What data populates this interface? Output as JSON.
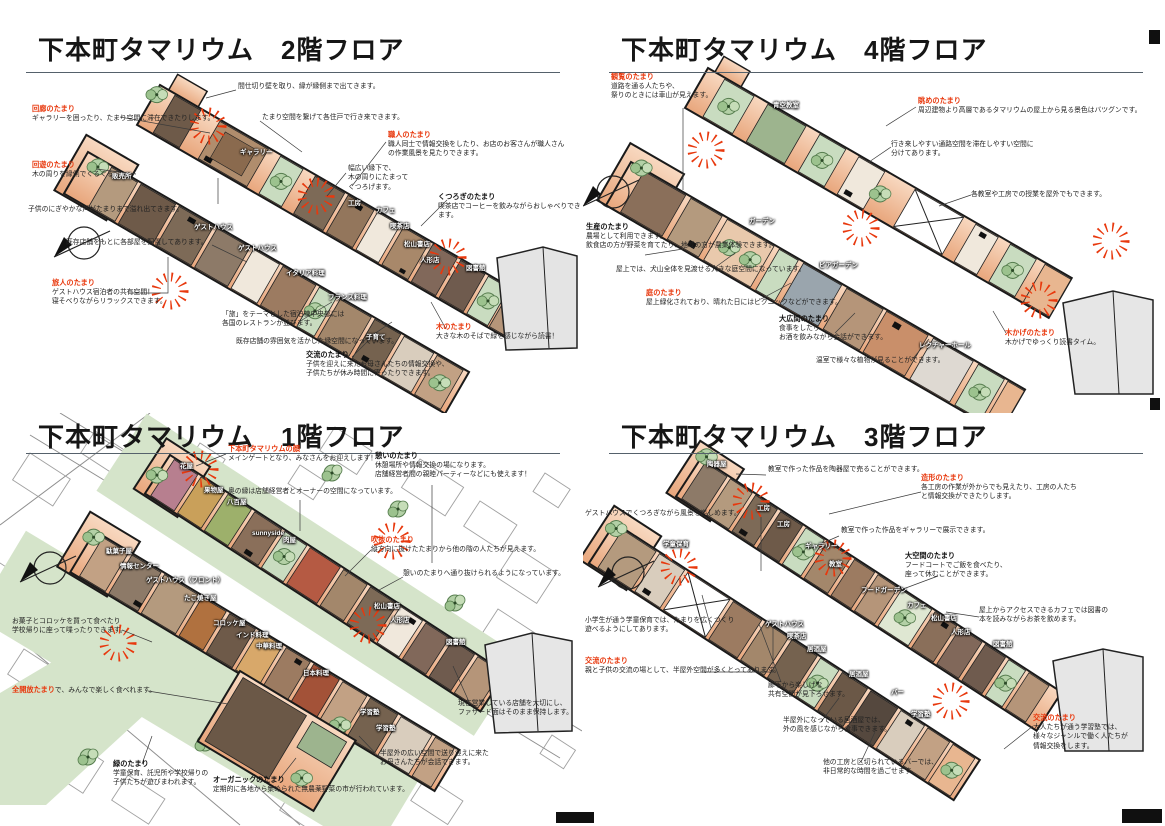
{
  "palette": {
    "accent_red": "#e8380d",
    "strip_fill": "#f2c09c",
    "green_path": "#d5e4ca"
  },
  "quadrants": [
    {
      "title": "下本町タマリウム　2階フロア",
      "annotations": [
        {
          "body": "間仕切り壁を取り、縁が縁側まで出てきます。"
        },
        {
          "title": "回廊のたまり",
          "body": "ギャラリーを囲ったり、たまり空間に滞在できたりします。"
        },
        {
          "body": "たまり空間を繋げて各住戸で行き来できます。"
        },
        {
          "title": "職人のたまり",
          "body": "職人同士で情報交換をしたり、お店のお客さんが職人さん\nの作業風景を見たりできます。"
        },
        {
          "body": "幅広い縁下で、\n木の周りにたまって\nくつろげます。"
        },
        {
          "title": "回遊のたまり",
          "body": "木の周りを縁側でぐるぐる"
        },
        {
          "body": "子供のにぎやかな声がたまりまで溢れ出てきます。"
        },
        {
          "title": "くつろぎのたまり",
          "body": "喫茶店でコーヒーを飲みながらおしゃべりできます。"
        },
        {
          "body": "既存店舗をもとに各部屋を配置してあります。"
        },
        {
          "title": "旅人のたまり",
          "body": "ゲストハウス宿泊者の共有空間！\n寝そべりながらリラックスできます。"
        },
        {
          "body": "「旅」をテーマとした宿泊棟中央部には\n各国のレストランが並びます。"
        },
        {
          "body": "既存店舗の雰囲気を活かした縁空間になっています。"
        },
        {
          "title": "木のたまり",
          "body": "大きな木のそばで緑を感じながら読書！"
        },
        {
          "title": "交流のたまり",
          "body": "子供を迎えに来たお母さんたちの情報交換や、\n子供たちが休み時間に寄ったりできます。"
        }
      ],
      "rooms": [
        "ギャラリー",
        "販売所",
        "工房",
        "カフェ",
        "喫茶店",
        "松山書店",
        "人形店",
        "図書館",
        "ゲストハウス",
        "ゲストハウス",
        "イタリア料理",
        "フランス料理",
        "子育て"
      ]
    },
    {
      "title": "下本町タマリウム　4階フロア",
      "annotations": [
        {
          "title": "観覧のたまり",
          "body": "道路を通る人たちや、\n祭りのときには車山が見えます。"
        },
        {
          "title": "眺めのたまり",
          "body": "周辺建物より高層であるタマリウムの屋上から見る景色はバツグンです。"
        },
        {
          "body": "行き来しやすい通路空間を滞在しやすい空間に\n分けてあります。"
        },
        {
          "body": "各教室や工房での授業を屋外でもできます。"
        },
        {
          "title": "生産のたまり",
          "body": "農場として利用できます。\n飲食店の方が野菜を育てたり、地域の方が農業体験できます。"
        },
        {
          "body": "屋上では、犬山全体を見渡せる大きな庭空間になっています。"
        },
        {
          "title": "庭のたまり",
          "body": "屋上緑化されており、晴れた日にはピクニックなどができます。"
        },
        {
          "title": "大広間のたまり",
          "body": "食事をしたり、\nお酒を飲みながら会話ができます。"
        },
        {
          "body": "温室で様々な植物が見ることができます。"
        },
        {
          "title": "木かげのたまり",
          "body": "木かげでゆっくり読書タイム。"
        }
      ],
      "rooms": [
        "青空教室",
        "ガーデン",
        "ビアガーデン",
        "レクチャーホール"
      ]
    },
    {
      "title": "下本町タマリウム　1階フロア",
      "annotations": [
        {
          "title": "下本町タマリウムの顔",
          "body": "メインゲートとなり、みなさんをお迎えします！"
        },
        {
          "title": "憩いのたまり",
          "body": "休憩場所や情報交換の場になります。\n店舗経営者間の親睦パーティーなどにも使えます！"
        },
        {
          "body": "奥の縁は店舗経営者とオーナーの空間になっています。"
        },
        {
          "title": "吹抜のたまり",
          "body": "縦方向に抜けたたまりから他の階の人たちが見えます。"
        },
        {
          "body": "憩いのたまりへ通り抜けられるようになっています。"
        },
        {
          "body": "お菓子とコロッケを買って食べたり\n学校帰りに座って喋ったりできます。"
        },
        {
          "title": "全開放たまり",
          "body": "で、みんなで楽しく食べれます。"
        },
        {
          "title": "緑のたまり",
          "body": "学童保育、託児所や学校帰りの\n子供たちが遊びまわれます。"
        },
        {
          "title": "オーガニックのたまり",
          "body": "定期的に各地から集められた無農薬野菜の市が行われています。"
        },
        {
          "body": "半屋外の広い空間で送り迎えに来た\nお母さんたちが会話できます。"
        },
        {
          "body": "現在営業している店舗を大切にし、\nファサード面はそのまま保持します。"
        }
      ],
      "rooms": [
        "花屋",
        "果物屋",
        "八百屋",
        "sunnyside",
        "肉屋",
        "松山書店",
        "人形店",
        "図書館",
        "駄菓子屋",
        "情報センター",
        "ゲストハウス（フロント）",
        "たこ焼き屋",
        "コロッケ屋",
        "インド料理",
        "中華料理",
        "日本料理",
        "学習塾",
        "学習塾"
      ]
    },
    {
      "title": "下本町タマリウム　3階フロア",
      "annotations": [
        {
          "body": "教室で作った作品を陶器屋で売ることができます。"
        },
        {
          "title": "造形のたまり",
          "body": "各工房の作業が外からでも見えたり、工房の人たち\nと情報交換ができたりします。"
        },
        {
          "body": "ゲストハウスでくつろぎながら風景を楽しめます。"
        },
        {
          "body": "教室で作った作品をギャラリーで展示できます。"
        },
        {
          "title": "大空間のたまり",
          "body": "フードコートでご飯を食べたり、\n座って休むことができます。"
        },
        {
          "body": "屋上からアクセスできるカフェでは図書の\n本を読みながらお茶を飲めます。"
        },
        {
          "body": "小学生が通う学童保育では、たまりを広くつくり\n遊べるようにしてあります。"
        },
        {
          "title": "交流のたまり",
          "body": "親と子供の交流の場として、半屋外空間が多くとってあります。"
        },
        {
          "body": "廊下から楽しげな\n共有空間が見下ろせます。"
        },
        {
          "body": "半屋外になっている居酒屋では、\n外の風を感じながら食事できます。"
        },
        {
          "body": "他の工房と区切られているバーでは、\n非日常的な時間を過ごせます。"
        },
        {
          "title": "交流のたまり",
          "body": "大人たちが通う学習塾では、\n様々なジャンルで働く人たちが\n情報交換をします。"
        }
      ],
      "rooms": [
        "陶器屋",
        "工房",
        "工房",
        "ギャラリー",
        "教室",
        "フードガーデン",
        "カフェ",
        "松山書店",
        "人形店",
        "図書館",
        "学童保育",
        "ゲストハウス",
        "喫茶店",
        "居酒屋",
        "居酒屋",
        "バー",
        "学習塾"
      ]
    }
  ]
}
